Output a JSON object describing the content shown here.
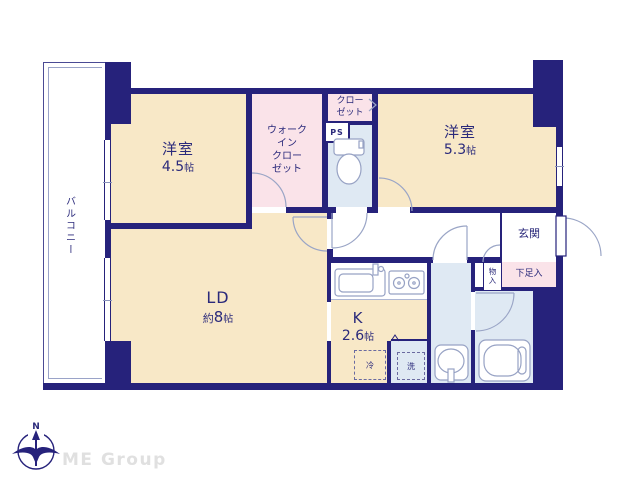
{
  "brand": {
    "name": "ME Group"
  },
  "compass": {
    "north_label": "N"
  },
  "rooms": {
    "bedroom_45": {
      "name": "洋室",
      "size_value": "4.5",
      "size_unit": "帖"
    },
    "bedroom_53": {
      "name": "洋室",
      "size_value": "5.3",
      "size_unit": "帖"
    },
    "living_dining": {
      "name": "LD",
      "size_prefix": "約",
      "size_value": "8",
      "size_unit": "帖"
    },
    "kitchen": {
      "name": "K",
      "size_value": "2.6",
      "size_unit": "帖"
    },
    "walk_in_closet": {
      "lines": [
        "ウォーク",
        "イン",
        "クロー",
        "ゼット"
      ]
    },
    "closet": {
      "lines": [
        "クロー",
        "ゼット"
      ]
    },
    "pipe_space": {
      "label": "PS"
    },
    "entrance": {
      "label": "玄関"
    },
    "shoe_cabinet": {
      "label": "下足入"
    },
    "storage": {
      "lines": [
        "物",
        "入"
      ]
    },
    "balcony": {
      "label": "バルコニー"
    },
    "refrigerator": {
      "label": "冷"
    },
    "washer": {
      "label": "洗"
    }
  },
  "colors": {
    "wall": "#26227B",
    "room_cream": "#F8E8C7",
    "closet_pink": "#FAE3E9",
    "wet_area_blue": "#DFE9F3",
    "fixture_line": "#97A2C4",
    "watermark_gray": "#E0E0E0"
  }
}
